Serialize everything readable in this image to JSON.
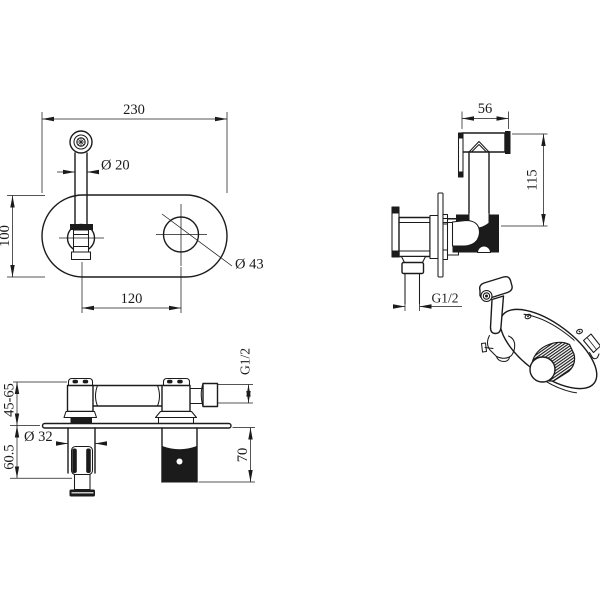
{
  "front_view": {
    "plate_width": "230",
    "sprayer_tube_diameter": "Ø 20",
    "plate_height": "100",
    "center_spacing": "120",
    "hole_diameter": "Ø 43"
  },
  "side_view": {
    "sprayer_head_width": "56",
    "sprayer_height": "115",
    "outlet_thread": "G1/2"
  },
  "section_view": {
    "wall_depth_range": "45-65",
    "valve_diameter": "Ø 32",
    "handle_depth": "60.5",
    "outlet_thread": "G1/2",
    "spout_depth": "70"
  },
  "colors": {
    "line": "#1b1b1b",
    "background": "#ffffff"
  }
}
